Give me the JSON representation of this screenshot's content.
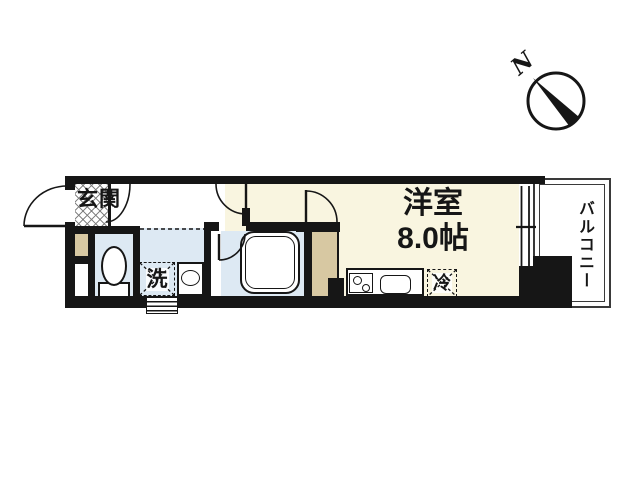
{
  "labels": {
    "entrance": "玄関",
    "room_name": "洋室",
    "room_size": "8.0帖",
    "washer": "洗",
    "fridge": "冷",
    "balcony": "バルコニー",
    "compass_north": "N"
  },
  "colors": {
    "wall": "#161616",
    "room_floor": "#f9f5e0",
    "wet_floor": "#dde9f3",
    "closet_floor": "#d7c8a2",
    "balcony_line": "#3a3a3a",
    "background": "#ffffff"
  }
}
